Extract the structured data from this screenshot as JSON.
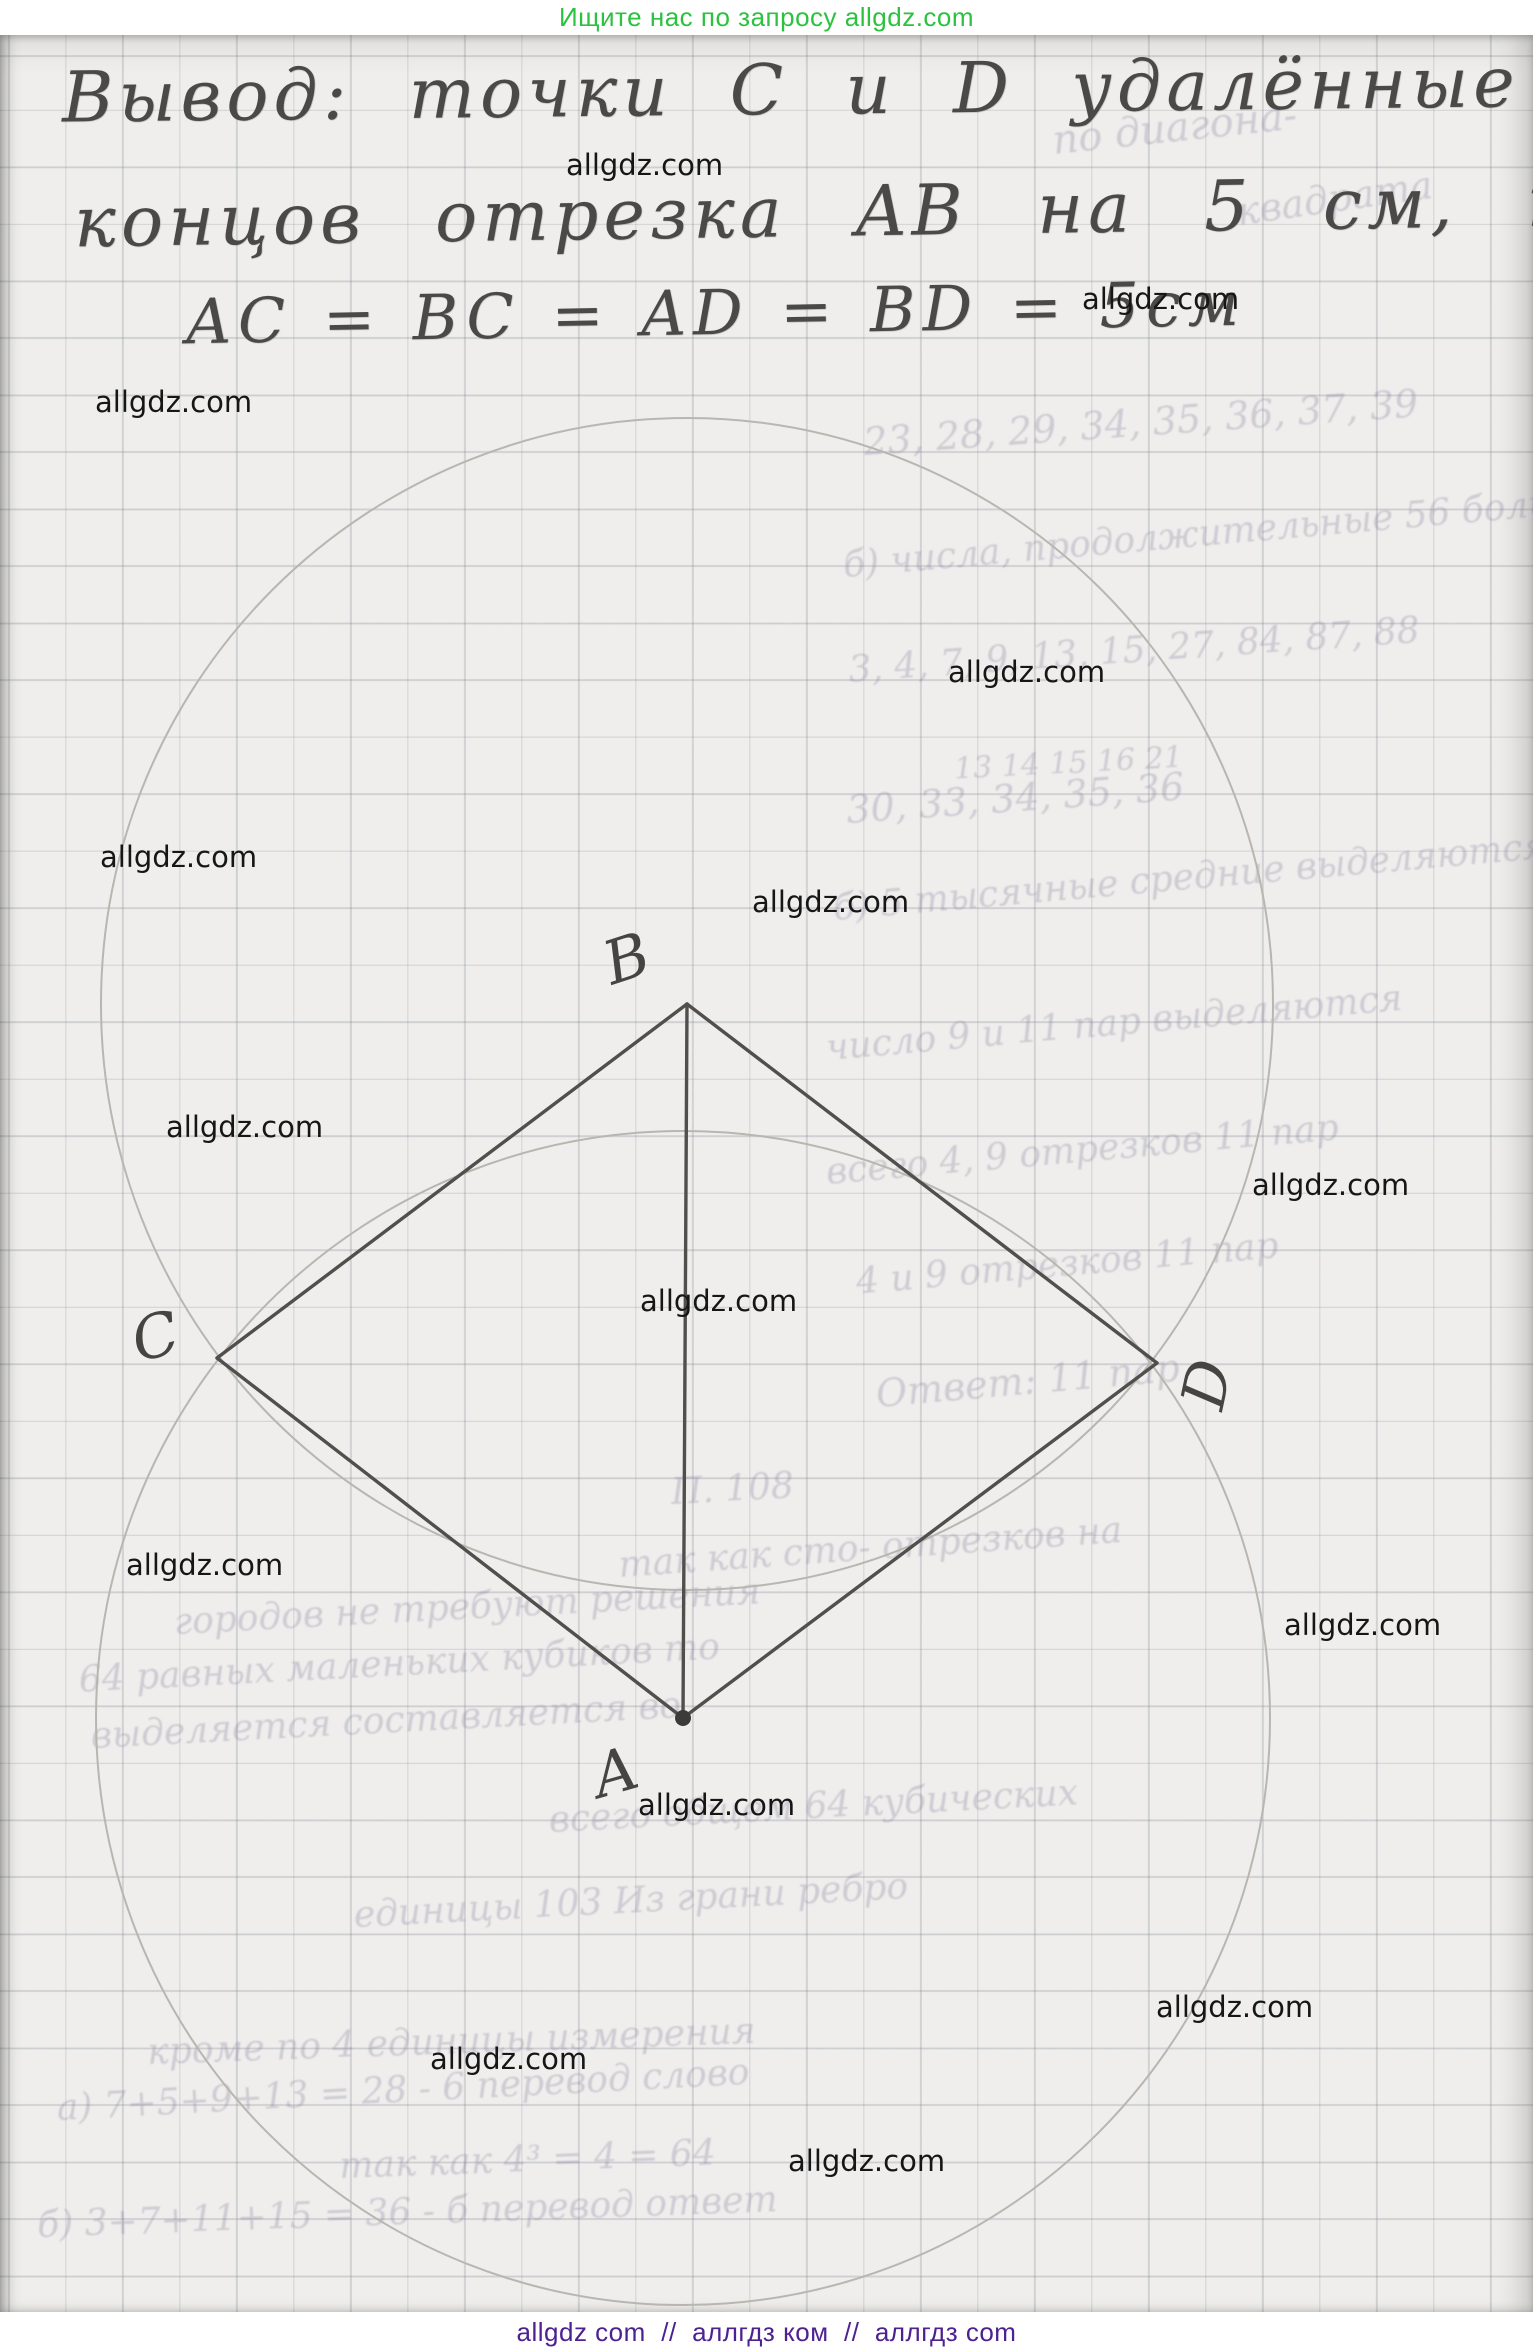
{
  "header": {
    "text": "Ищите нас по запросу allgdz.com",
    "color": "#2cc240"
  },
  "footer": {
    "text": "allgdz com  //  аллгдз ком  //  аллгдз com",
    "color": "#4e2191"
  },
  "solution": {
    "line1": "Вывод: точки C и D удалённые от",
    "line2": "концов отрезка AB на 5 см, т.е.",
    "line3": "AC = BC = AD = BD = 5см"
  },
  "watermark_text": "allgdz.com",
  "watermarks": [
    {
      "x": 566,
      "y": 148
    },
    {
      "x": 1082,
      "y": 282
    },
    {
      "x": 95,
      "y": 385
    },
    {
      "x": 948,
      "y": 655
    },
    {
      "x": 100,
      "y": 840
    },
    {
      "x": 752,
      "y": 885
    },
    {
      "x": 166,
      "y": 1110
    },
    {
      "x": 1252,
      "y": 1168
    },
    {
      "x": 640,
      "y": 1284
    },
    {
      "x": 126,
      "y": 1548
    },
    {
      "x": 1284,
      "y": 1608
    },
    {
      "x": 638,
      "y": 1788
    },
    {
      "x": 1156,
      "y": 1990
    },
    {
      "x": 430,
      "y": 2042
    },
    {
      "x": 788,
      "y": 2144
    }
  ],
  "figure": {
    "circles": [
      {
        "name": "construction-circle-center-B",
        "cx": 687,
        "cy": 1004,
        "r": 586
      },
      {
        "name": "construction-circle-center-A",
        "cx": 683,
        "cy": 1718,
        "r": 587
      }
    ],
    "segments": [
      {
        "name": "segment-BC",
        "x1": 687,
        "y1": 1004,
        "x2": 217,
        "y2": 1358
      },
      {
        "name": "segment-BD",
        "x1": 687,
        "y1": 1004,
        "x2": 1157,
        "y2": 1363
      },
      {
        "name": "segment-CA",
        "x1": 217,
        "y1": 1358,
        "x2": 683,
        "y2": 1718
      },
      {
        "name": "segment-DA",
        "x1": 1157,
        "y1": 1363,
        "x2": 683,
        "y2": 1718
      },
      {
        "name": "segment-BA",
        "x1": 687,
        "y1": 1004,
        "x2": 683,
        "y2": 1718
      }
    ],
    "dot": {
      "name": "point-A-dot",
      "cx": 683,
      "cy": 1718,
      "r": 8
    },
    "labels": [
      {
        "name": "label-B",
        "text": "B",
        "x": 612,
        "y": 985,
        "rot": -18
      },
      {
        "name": "label-C",
        "text": "C",
        "x": 138,
        "y": 1362,
        "rot": -14
      },
      {
        "name": "label-D",
        "text": "D",
        "x": 1222,
        "y": 1412,
        "rot": -78
      },
      {
        "name": "label-A",
        "text": "A",
        "x": 600,
        "y": 1798,
        "rot": -16
      }
    ]
  },
  "ghost_text": [
    {
      "text": "по диагона-",
      "x": 1055,
      "y": 118,
      "size": 40,
      "rot": -6
    },
    {
      "text": "квадрата",
      "x": 1240,
      "y": 190,
      "size": 38,
      "rot": -8
    },
    {
      "text": "23, 28, 29, 34, 35, 36, 37, 39",
      "x": 865,
      "y": 420,
      "size": 38,
      "rot": -4
    },
    {
      "text": "б) числа, продолжительные 56 больше",
      "x": 845,
      "y": 545,
      "size": 36,
      "rot": -5
    },
    {
      "text": "3, 4, 7, 9, 13, 15, 27, 84, 87, 88",
      "x": 850,
      "y": 650,
      "size": 36,
      "rot": -4
    },
    {
      "text": "13  14  15  16  21",
      "x": 955,
      "y": 752,
      "size": 30,
      "rot": -3
    },
    {
      "text": "30, 33, 34, 35, 36",
      "x": 848,
      "y": 788,
      "size": 38,
      "rot": -4
    },
    {
      "text": "б) 5 тысячные средние выделяются",
      "x": 835,
      "y": 888,
      "size": 36,
      "rot": -5
    },
    {
      "text": "число 9 и 11 пар выделяются",
      "x": 828,
      "y": 1028,
      "size": 36,
      "rot": -5
    },
    {
      "text": "всего 4, 9 отрезков 11 пар",
      "x": 828,
      "y": 1152,
      "size": 36,
      "rot": -5
    },
    {
      "text": "4 и 9 отрезков 11 пар",
      "x": 858,
      "y": 1262,
      "size": 36,
      "rot": -5
    },
    {
      "text": "Ответ: 11 пар",
      "x": 878,
      "y": 1372,
      "size": 38,
      "rot": -5
    },
    {
      "text": "П. 108",
      "x": 672,
      "y": 1472,
      "size": 36,
      "rot": -3
    },
    {
      "text": "так как сто- отрезков на",
      "x": 620,
      "y": 1545,
      "size": 36,
      "rot": -4
    },
    {
      "text": "городов не требуют решения",
      "x": 175,
      "y": 1602,
      "size": 36,
      "rot": -3
    },
    {
      "text": "64 равных маленьких кубиков то",
      "x": 80,
      "y": 1660,
      "size": 36,
      "rot": -3
    },
    {
      "text": "выделяется составляется во",
      "x": 92,
      "y": 1716,
      "size": 36,
      "rot": -3
    },
    {
      "text": "всего общем 64 кубических",
      "x": 550,
      "y": 1800,
      "size": 36,
      "rot": -3
    },
    {
      "text": "единицы 103 Из грани ребро",
      "x": 355,
      "y": 1895,
      "size": 36,
      "rot": -3
    },
    {
      "text": "кроме по 4 единицы измерения",
      "x": 148,
      "y": 2032,
      "size": 36,
      "rot": -2
    },
    {
      "text": "а) 7+5+9+13 = 28 - 6 перевод слово",
      "x": 58,
      "y": 2088,
      "size": 36,
      "rot": -3
    },
    {
      "text": "так как 4³ = 4 = 64",
      "x": 340,
      "y": 2146,
      "size": 36,
      "rot": -2
    },
    {
      "text": "б) 3+7+11+15 = 36 - б перевод ответ",
      "x": 38,
      "y": 2205,
      "size": 36,
      "rot": -2
    }
  ],
  "colors": {
    "header_green": "#2cc240",
    "footer_purple": "#4e2191",
    "pencil": "#4c4b48",
    "construction_arc": "#b8b6b0",
    "watermark": "#161616",
    "paper": "#efeeec",
    "grid_line": "#c3c6c9"
  }
}
